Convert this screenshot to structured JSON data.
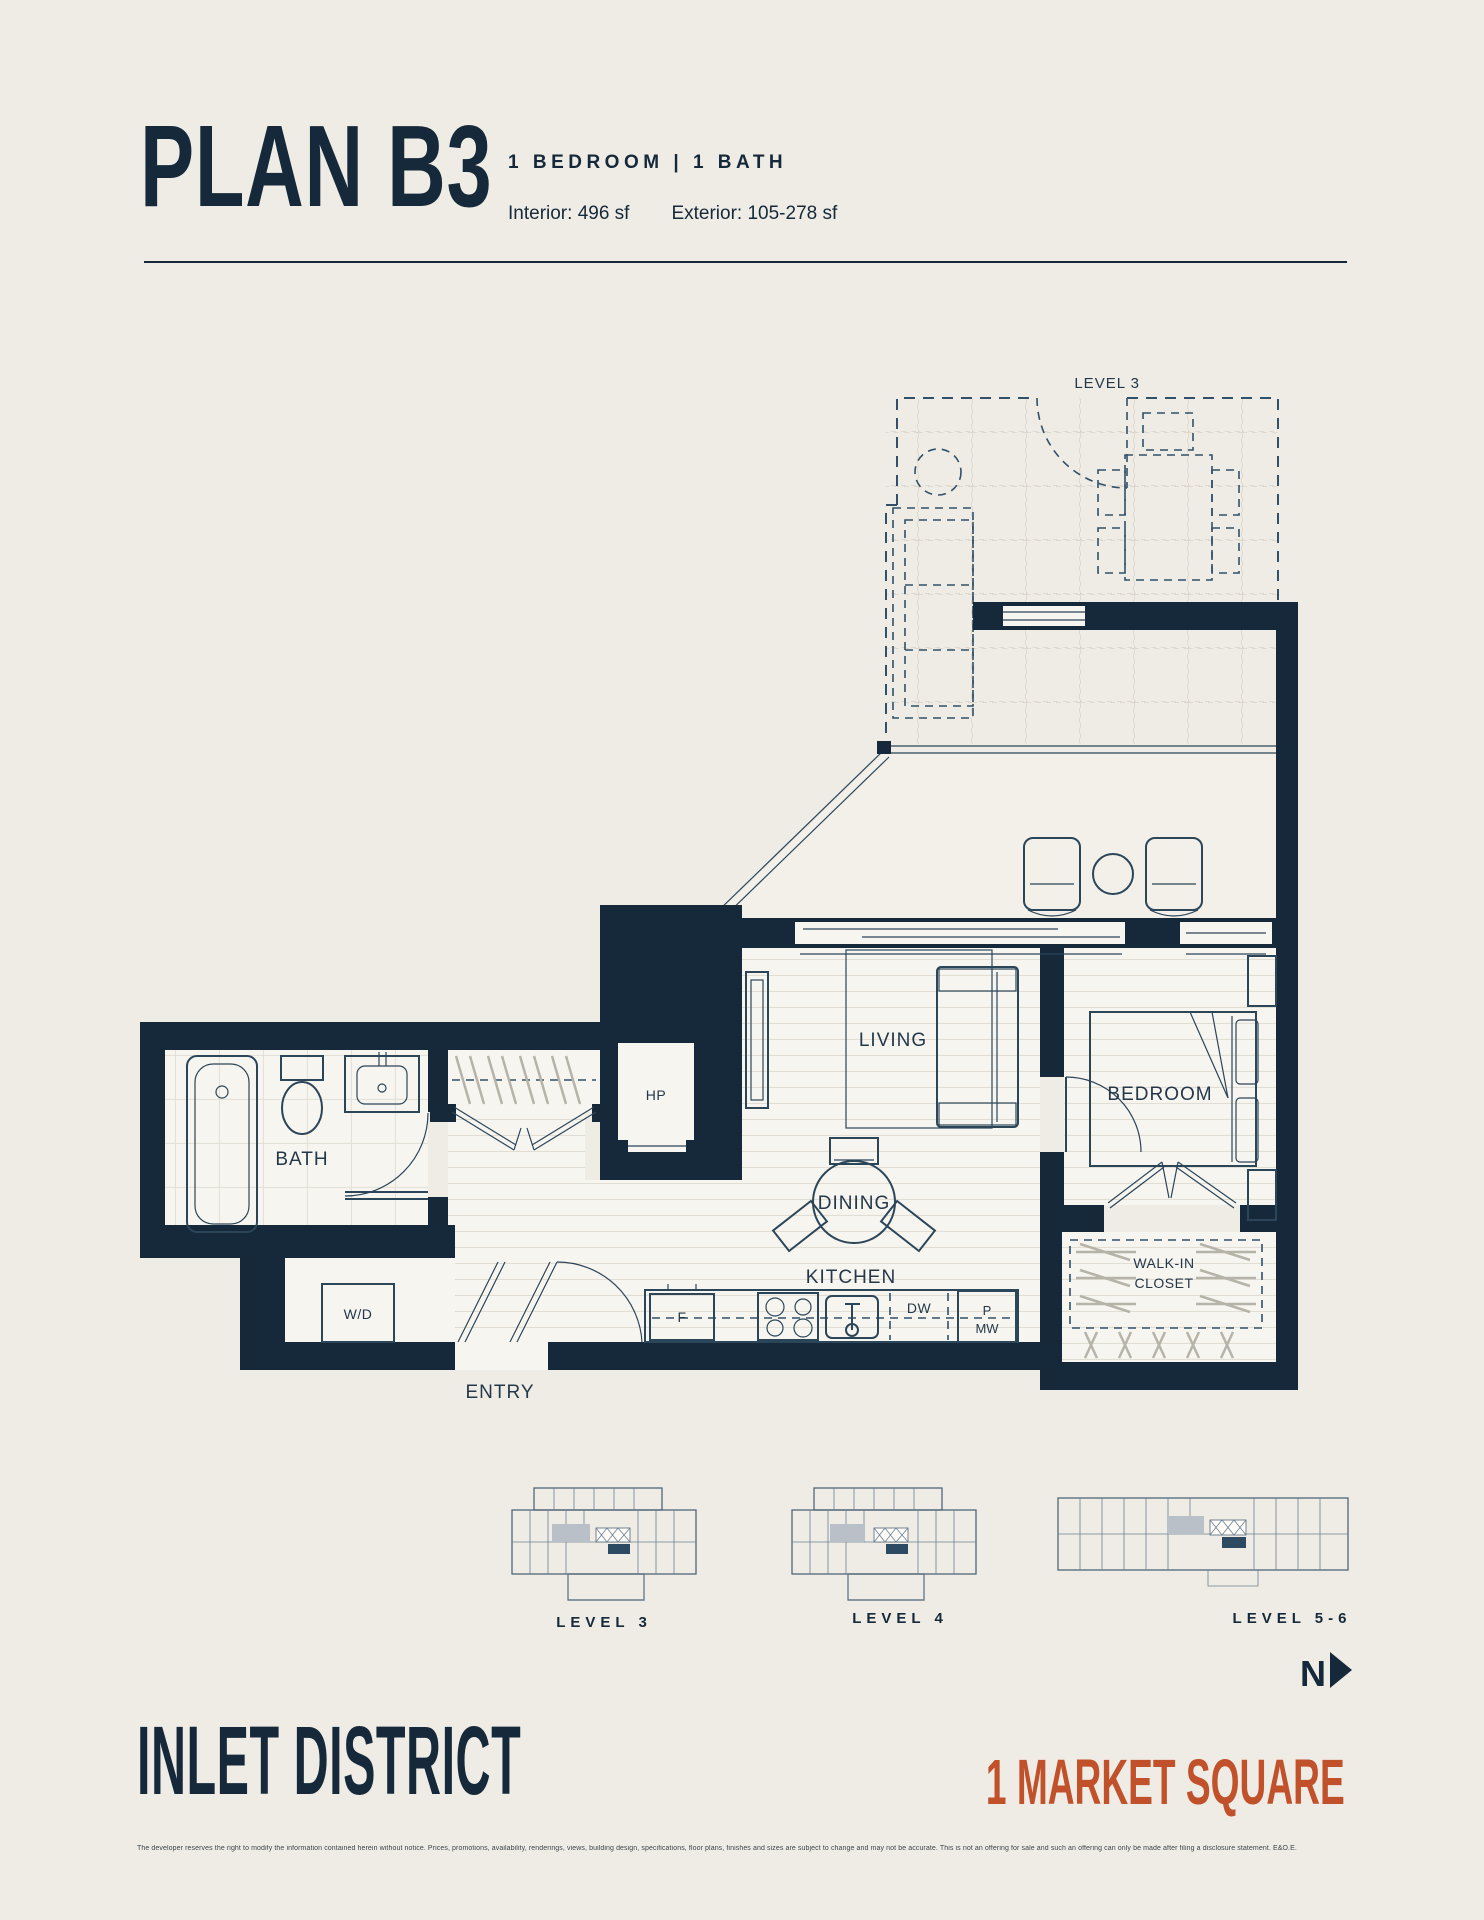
{
  "colors": {
    "background": "#efece5",
    "ink": "#15293a",
    "accent": "#c0512a"
  },
  "header": {
    "title": "PLAN B3",
    "subtitle": "1 BEDROOM   |   1 BATH",
    "interior": "Interior: 496 sf",
    "exterior": "Exterior: 105-278 sf"
  },
  "plan": {
    "deck_label": "LEVEL 3",
    "rooms": {
      "bath": "BATH",
      "entry": "ENTRY",
      "living": "LIVING",
      "dining": "DINING",
      "kitchen": "KITCHEN",
      "bedroom": "BEDROOM",
      "walkin_line1": "WALK-IN",
      "walkin_line2": "CLOSET"
    },
    "fixtures": {
      "hp": "HP",
      "wd": "W/D",
      "fridge": "F",
      "dishwasher": "DW",
      "pantry": "P",
      "microwave": "MW"
    }
  },
  "keyplans": [
    {
      "label": "LEVEL 3"
    },
    {
      "label": "LEVEL 4"
    },
    {
      "label": "LEVEL 5-6"
    }
  ],
  "compass": {
    "north": "N"
  },
  "footer": {
    "brand": "INLET DISTRICT",
    "address": "1 MARKET SQUARE",
    "disclaimer": "The developer reserves the right to modify the information contained herein without notice. Prices, promotions, availability, renderings, views, building design, specifications, floor plans, finishes and sizes are subject to change and may not be accurate. This is not an offering for sale and such an offering can only be made after filing a disclosure statement. E&O.E."
  }
}
